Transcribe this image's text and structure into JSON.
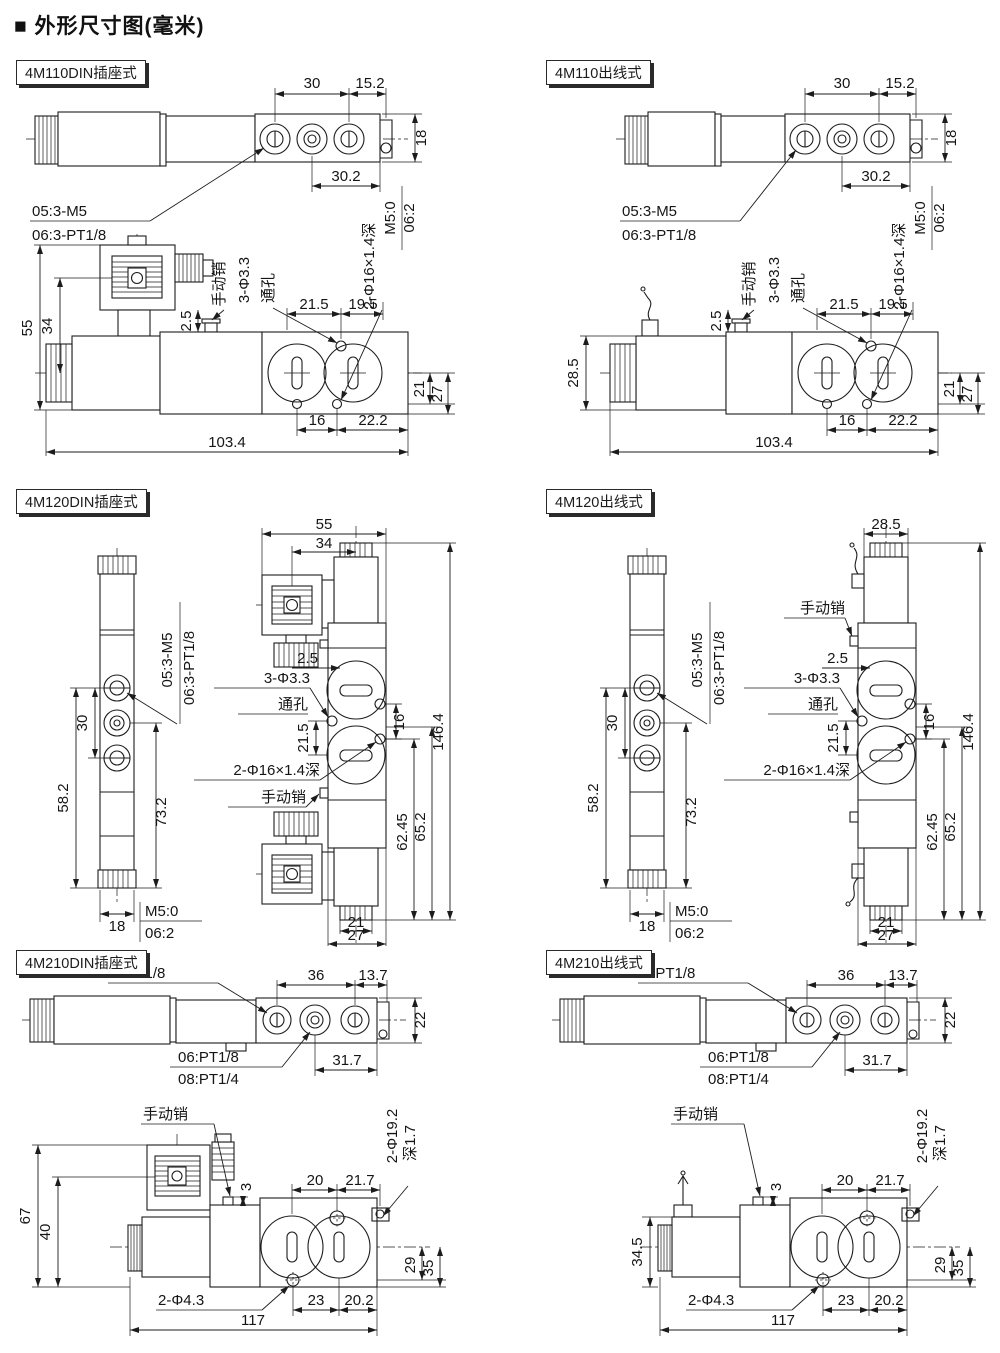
{
  "title": "■ 外形尺寸图(毫米)",
  "panels": [
    {
      "header": "4M110DIN插座式",
      "top": {
        "d30": "30",
        "d15_2": "15.2",
        "d18": "18",
        "d30_2": "30.2",
        "m5": "M5:0",
        "o06": "06:2",
        "l1": "05:3-M5",
        "l2": "06:3-PT1/8"
      },
      "side": {
        "d55": "55",
        "d34": "34",
        "d2_5": "2.5",
        "pin": "手动销",
        "holes": "3-Φ3.3",
        "through": "通孔",
        "cbore": "2-Φ16×1.4深",
        "d21_5": "21.5",
        "d19_5": "19.5",
        "d21": "21",
        "d27": "27",
        "d16": "16",
        "d22_2": "22.2",
        "d103_4": "103.4"
      }
    },
    {
      "header": "4M110出线式",
      "top": {
        "d30": "30",
        "d15_2": "15.2",
        "d18": "18",
        "d30_2": "30.2",
        "m5": "M5:0",
        "o06": "06:2",
        "l1": "05:3-M5",
        "l2": "06:3-PT1/8"
      },
      "side": {
        "d28_5": "28.5",
        "d2_5": "2.5",
        "pin": "手动销",
        "holes": "3-Φ3.3",
        "through": "通孔",
        "cbore": "2-Φ16×1.4深",
        "d21_5": "21.5",
        "d19_5": "19.5",
        "d21": "21",
        "d27": "27",
        "d16": "16",
        "d22_2": "22.2",
        "d103_4": "103.4"
      }
    },
    {
      "header": "4M120DIN插座式",
      "valve": {
        "l1": "05:3-M5",
        "l2": "06:3-PT1/8",
        "d30": "30",
        "d58_2": "58.2",
        "d73_2": "73.2",
        "d18": "18",
        "m5": "M5:0",
        "o06": "06:2"
      },
      "front": {
        "d55": "55",
        "d34": "34",
        "d2_5": "2.5",
        "holes": "3-Φ3.3",
        "through": "通孔",
        "d21_5": "21.5",
        "d16": "16",
        "cbore": "2-Φ16×1.4深",
        "pin": "手动销",
        "d62_45": "62.45",
        "d65_2": "65.2",
        "d146_4": "146.4",
        "d21": "21",
        "d27": "27"
      }
    },
    {
      "header": "4M120出线式",
      "valve": {
        "l1": "05:3-M5",
        "l2": "06:3-PT1/8",
        "d30": "30",
        "d58_2": "58.2",
        "d73_2": "73.2",
        "d18": "18",
        "m5": "M5:0",
        "o06": "06:2"
      },
      "front": {
        "d28_5": "28.5",
        "d2_5": "2.5",
        "holes": "3-Φ3.3",
        "through": "通孔",
        "d21_5": "21.5",
        "d16": "16",
        "cbore": "2-Φ16×1.4深",
        "pin": "手动销",
        "d62_45": "62.45",
        "d65_2": "65.2",
        "d146_4": "146.4",
        "d21": "21",
        "d27": "27"
      }
    },
    {
      "header": "4M210DIN插座式",
      "top": {
        "ports": "2-PT1/8",
        "d36": "36",
        "d13_7": "13.7",
        "d22": "22",
        "l1": "06:PT1/8",
        "l2": "08:PT1/4",
        "d31_7": "31.7"
      },
      "side": {
        "pin": "手动销",
        "d67": "67",
        "d40": "40",
        "d3": "3",
        "d20": "20",
        "d21_7": "21.7",
        "cbore": "2-Φ19.2",
        "depth": "深1.7",
        "d29": "29",
        "d35": "35",
        "holes": "2-Φ4.3",
        "d23": "23",
        "d20_2": "20.2",
        "d117": "117"
      }
    },
    {
      "header": "4M210出线式",
      "top": {
        "ports": "2-PT1/8",
        "d36": "36",
        "d13_7": "13.7",
        "d22": "22",
        "l1": "06:PT1/8",
        "l2": "08:PT1/4",
        "d31_7": "31.7"
      },
      "side": {
        "pin": "手动销",
        "d34_5": "34.5",
        "d3": "3",
        "d20": "20",
        "d21_7": "21.7",
        "cbore": "2-Φ19.2",
        "depth": "深1.7",
        "d29": "29",
        "d35": "35",
        "holes": "2-Φ4.3",
        "d23": "23",
        "d20_2": "20.2",
        "d117": "117"
      }
    }
  ]
}
